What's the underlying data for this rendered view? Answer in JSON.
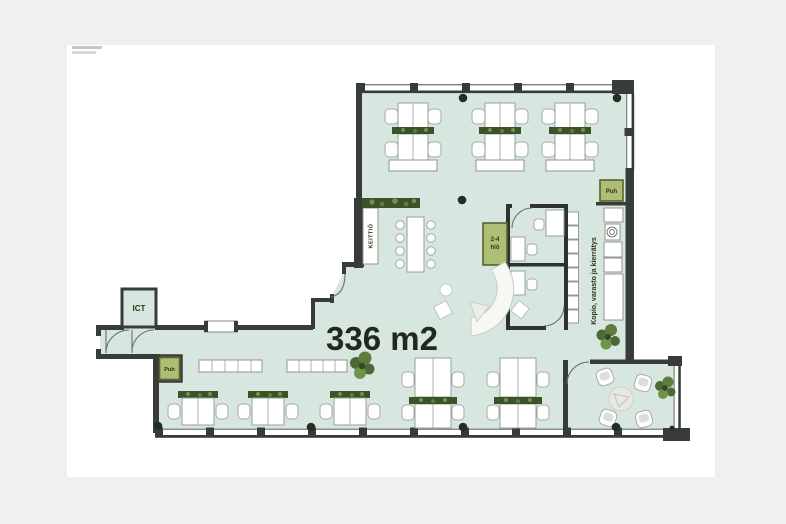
{
  "floor_plan": {
    "area_label": "336 m2",
    "rooms": {
      "ict": "ICT",
      "kitchen": "KEITTIÖ",
      "phone_booth_top": "Puh",
      "phone_booth_bottom": "Puh",
      "small_meeting_line1": "2-4",
      "small_meeting_line2": "hlö",
      "storage_corridor": "Kopio, varasto ja kierrätys"
    },
    "colors": {
      "page_background": "#f0f0ee",
      "sheet": "#ffffff",
      "floor": "#d7e6de",
      "wall": "#383c38",
      "accent_room_green": "#aebe75",
      "planter_green": "#3c5229",
      "label_text": "#2c3318"
    }
  }
}
